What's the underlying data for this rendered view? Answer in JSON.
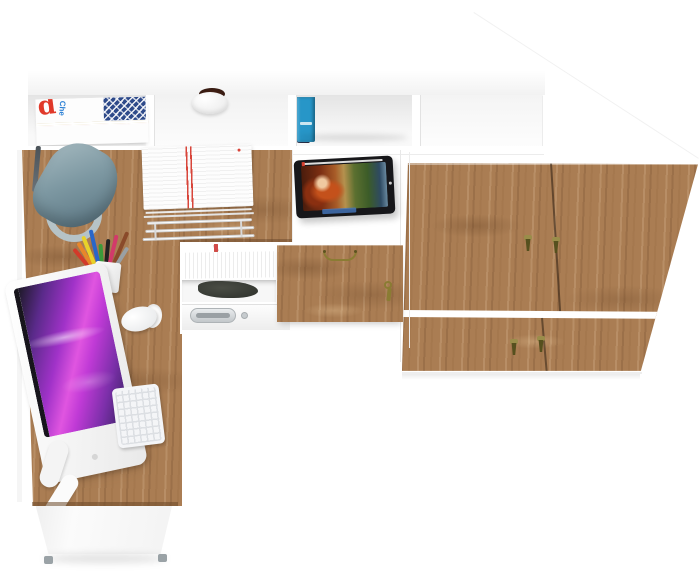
{
  "meta": {
    "type": "furniture-product-render",
    "description": "Top-down studio render of a white and craft-oak corner desk set: hutch shelving with magazines, plant pot and books, a wardrobe cabinet with four oak fronts and gold pendant pulls, an oak flap door with bow handle and hanging key, a tablet playing an animated movie, desk lamp, paper tray with documents, pencil cup, all-in-one monitor with magenta screen, white keyboard and mouse, and under-desk storage with files, drawer and aluminum handle.",
    "background_color": "#ffffff",
    "width": 700,
    "height": 574
  },
  "palette": {
    "oak": "#aa7d53",
    "oak_dark": "#6b4a2e",
    "white": "#ffffff",
    "lamp_shade": "#7d98a2",
    "lamp_base": "#b6c3c7",
    "screen_magenta": "#c03ad6",
    "handle_gold": "#8a7c33",
    "pendant_gold": "#9a8d4a",
    "aluminum": "#c2c7ca",
    "paper_stripe_red": "#d8453a"
  },
  "hutch": {
    "magazines": {
      "big_letter": "d",
      "small_word": "Che",
      "stripes": [
        {
          "c": "#ffffff",
          "h": 3
        },
        {
          "c": "#f0b7c4",
          "h": 3
        },
        {
          "c": "#e9e24b",
          "h": 2
        },
        {
          "c": "#ffffff",
          "h": 3
        },
        {
          "c": "#a8d8e8",
          "h": 2
        },
        {
          "c": "#ffffff",
          "h": 3
        },
        {
          "c": "#f4a7b9",
          "h": 2
        },
        {
          "c": "#d8e8a0",
          "h": 2
        },
        {
          "c": "#ffffff",
          "h": 2
        }
      ]
    },
    "plant_pot": {
      "pot_color": "#ffffff",
      "plant_color": "#3c2014"
    },
    "books": [
      {
        "color": "#8f2e36",
        "width": 12,
        "height": 34,
        "dy": 2
      },
      {
        "color": "#1f2947",
        "width": 13,
        "height": 46,
        "dy": 0
      },
      {
        "color": "#2f6cb4",
        "width": 14,
        "height": 36,
        "dy": 1,
        "label": "#c9a84c"
      },
      {
        "color": "#17171a",
        "width": 15,
        "height": 38,
        "dy": 0,
        "label": "#d8d8d8"
      },
      {
        "color": "#33622f",
        "width": 13,
        "height": 37,
        "dy": 1,
        "label": "#c9a84c"
      },
      {
        "color": "#5c2220",
        "width": 12,
        "height": 36,
        "dy": 1,
        "label": "#c9a84c"
      },
      {
        "color": "#d9cfba",
        "width": 11,
        "height": 37,
        "dy": 1
      },
      {
        "color": "#2796c8",
        "width": 18,
        "height": 45,
        "dy": 0,
        "label": "#e8f4f8"
      }
    ]
  },
  "wardrobe": {
    "material": "oak",
    "top_color": "#ffffff",
    "upper_doors": 2,
    "lower_drawers": 2,
    "handle_count": 4,
    "handle_color": "#9a8d4a",
    "handle_dark": "#56501e"
  },
  "desk": {
    "lamp": {
      "shade": "#7d98a2",
      "base": "#b6c3c7"
    },
    "paper_tray": {
      "paper": "#fdfdfd",
      "stripe": "#d8453a",
      "wire": "#d0d0d0"
    },
    "tablet": {
      "bezel": "#17171a",
      "subject": "animated movie frame with red-haired character",
      "progress_color": "#ffffff"
    },
    "flap_door": {
      "handle_color": "#8a7c33",
      "key_color": "#8a7c33"
    },
    "pencils": [
      "#d23a2a",
      "#e8862a",
      "#e8d22a",
      "#2a66c8",
      "#3a9a3a",
      "#222222",
      "#d23a6a",
      "#8a4a2a",
      "#9aa0a4"
    ],
    "file_tabs": [
      "#2a7fd4",
      "#7ac043",
      "#e8d22a",
      "#d23a2a",
      "#8a4ac8",
      "#e8862a",
      "#2ac0c0",
      "#d23a8a",
      "#4a6ad4",
      "#a0c83a",
      "#e8a02a",
      "#d24a4a"
    ],
    "monitor": {
      "body": "#ffffff",
      "screen_colors": [
        "#1d1926",
        "#5a2a8a",
        "#c03ad6",
        "#e26ae8",
        "#2e1f55"
      ]
    },
    "keyboard_color": "#f4f5f7",
    "mouse_color": "#ffffff",
    "drawer_handle_color": "#c2c7ca"
  }
}
